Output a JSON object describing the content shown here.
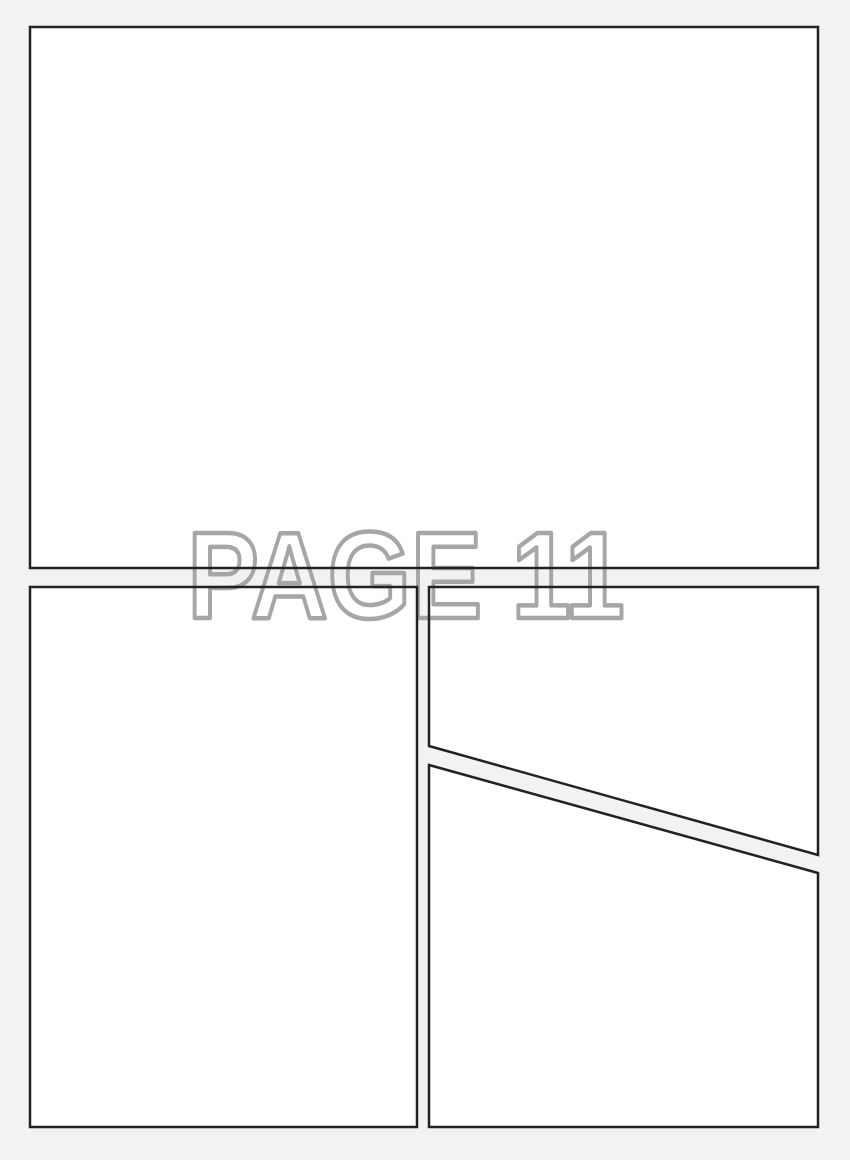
{
  "watermark": {
    "text": "PAGE 11"
  },
  "colors": {
    "background": "#f2f2f2",
    "panel_fill": "#ffffff",
    "panel_border": "#222222",
    "watermark_stroke": "#a6a6a6"
  },
  "panels": [
    {
      "id": "panel-1",
      "position": "top full-width"
    },
    {
      "id": "panel-2",
      "position": "bottom left column"
    },
    {
      "id": "panel-3",
      "position": "right column upper (diagonal bottom edge)"
    },
    {
      "id": "panel-4",
      "position": "right column lower (diagonal top edge)"
    }
  ]
}
